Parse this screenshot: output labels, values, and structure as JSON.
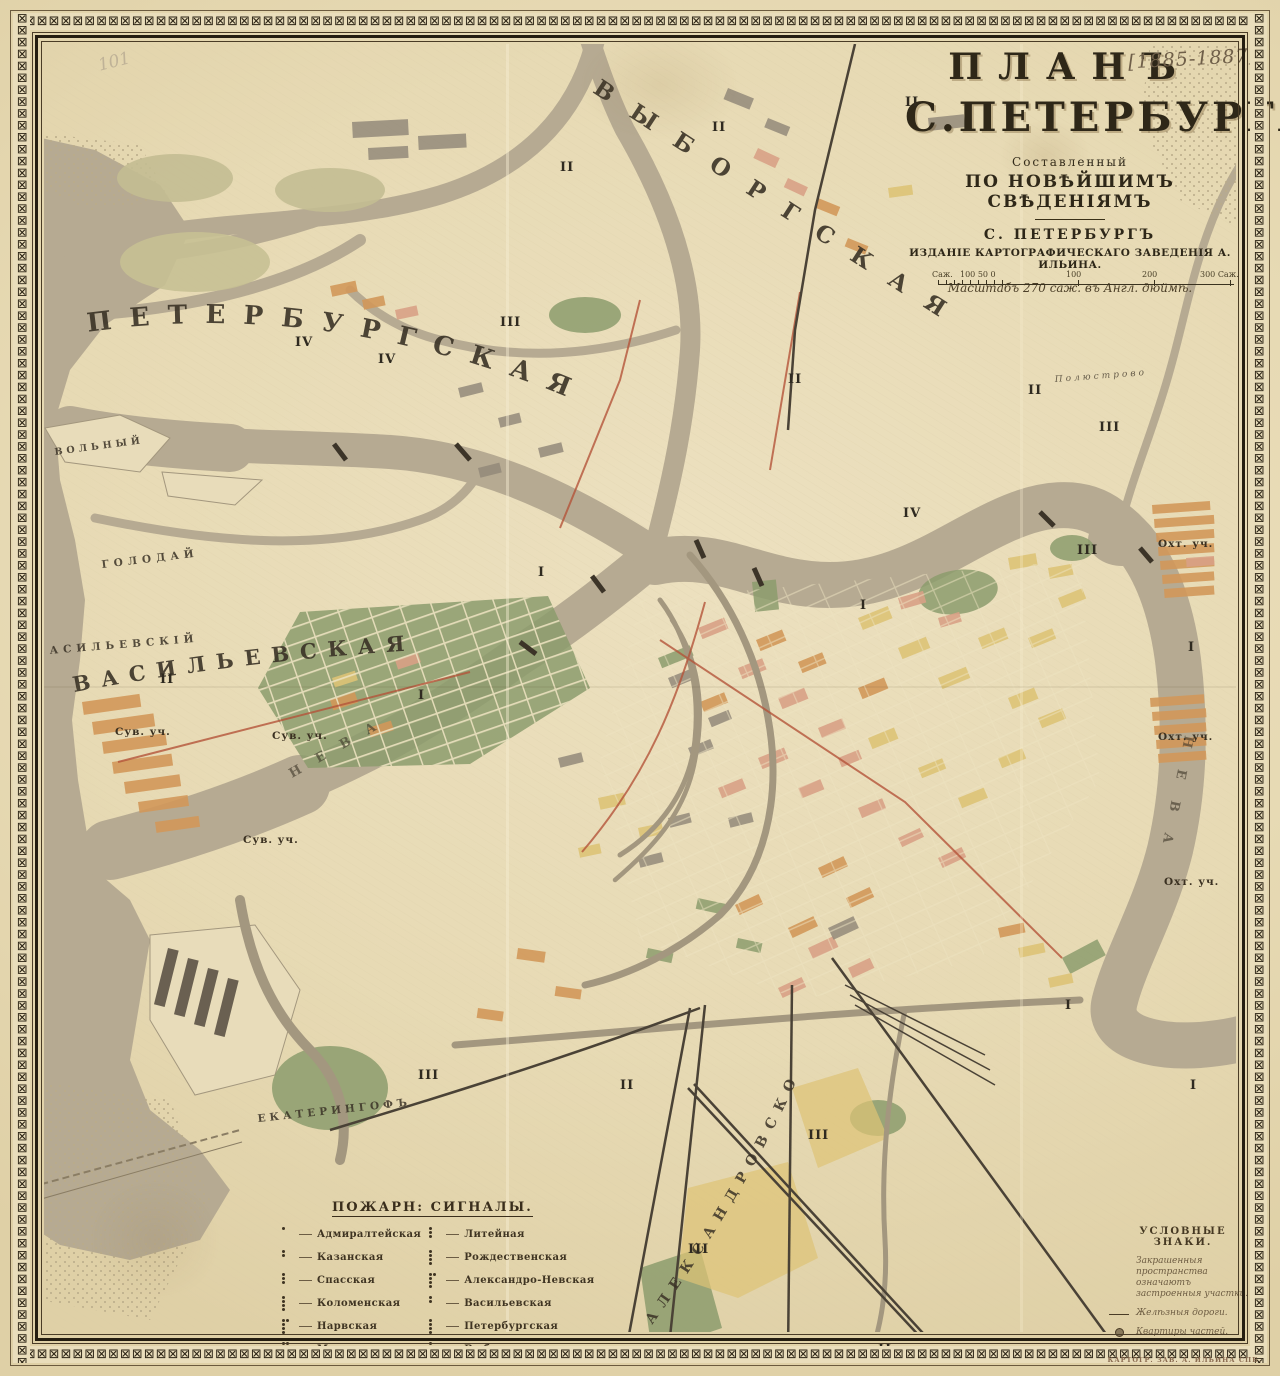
{
  "annotations": {
    "date_note": "[1885-1887]",
    "pencil_mark": "101"
  },
  "title_block": {
    "line1": "ПЛАНЪ",
    "line2": "С.ПЕТЕРБУРГА",
    "line3": "Составленный",
    "line4": "ПО НОВѢЙШИМЪ СВѢДЕНІЯМЪ",
    "city": "С. ПЕТЕРБУРГЪ",
    "publisher": "ИЗДАНІЕ КАРТОГРАФИЧЕСКАГО ЗАВЕДЕНІЯ А. ИЛЬИНА.",
    "scale_note": "Масштабъ 270 саж. въ Англ. дюймѣ.",
    "scale_bar": {
      "left_label": "Саж.",
      "sub_labels": "100  50  0",
      "major_labels": [
        "100",
        "200",
        "300 Саж."
      ]
    }
  },
  "map_labels": {
    "districts": {
      "petersburgskaya": "ПЕТЕРБУРГСКАЯ",
      "vasilyevskaya": "ВАСИЛЬЕВСКАЯ",
      "vasilyevsky_island": "ВАСИЛЬЕВСКІЙ",
      "vyborgskaya": "ВЫБОРГСКАЯ",
      "alexandrovskoe": "АЛЕКСАНДРОВСКОЕ",
      "ekateringof": "ЕКАТЕРИНГОФЪ",
      "goloday": "ГОЛОДАЙ",
      "volny": "ВОЛЬНЫЙ",
      "neva": "НЕВА",
      "polyustrovo": "Полюстрово"
    },
    "precincts": {
      "suvorovsky": "Сув. уч.",
      "okhtensky": "Охт. уч."
    },
    "numerals": [
      "I",
      "II",
      "III",
      "IV"
    ]
  },
  "fire_legend": {
    "title": "ПОЖАРН: СИГНАЛЫ.",
    "left": [
      {
        "name": "Адмиралтейская",
        "signal_dots": 1
      },
      {
        "name": "Казанская",
        "signal_dots": 2
      },
      {
        "name": "Спасская",
        "signal_dots": 3
      },
      {
        "name": "Коломенская",
        "signal_dots": 4
      },
      {
        "name": "Нарвская",
        "signal_dots": 5
      },
      {
        "name": "Московская",
        "signal_dots": 6
      }
    ],
    "right": [
      {
        "name": "Литейная",
        "signal_dots": 3
      },
      {
        "name": "Рождественская",
        "signal_dots": 4
      },
      {
        "name": "Александро-Невская",
        "signal_dots": 5
      },
      {
        "name": "Васильевская",
        "signal_dots": 2
      },
      {
        "name": "Петербургская",
        "signal_dots": 4
      },
      {
        "name": "Выборгская",
        "signal_dots": 3
      }
    ]
  },
  "symbols_legend": {
    "title": "УСЛОВНЫЕ ЗНАКИ.",
    "items": [
      {
        "symbol": "shaded-area",
        "label": "Закрашенныя пространства означаютъ застроенныя участки."
      },
      {
        "symbol": "railway-line",
        "label": "Желѣзныя дороги."
      },
      {
        "symbol": "precinct-office",
        "label": "Квартиры частей."
      }
    ]
  },
  "imprint": "КАРТОГР. ЗАВ. А. ИЛЬИНА СПБ.",
  "palette": {
    "paper": "#e9ddba",
    "water": "#b6aa92",
    "built_green": "#8c9c6d",
    "built_orange": "#d2985a",
    "built_yellow": "#ddc377",
    "built_salmon": "#d9a186",
    "built_gray": "#93897a",
    "ink": "#2e2718",
    "route_red": "#b4543a"
  }
}
